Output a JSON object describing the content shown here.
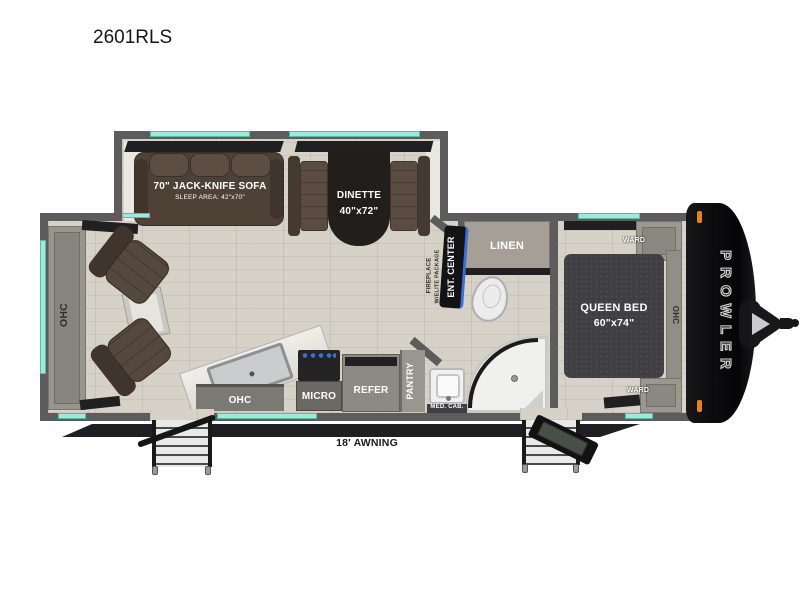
{
  "title": "2601RLS",
  "colors": {
    "teal": "#9fe9da",
    "wall": "#5c5c5c",
    "cap": "#0d0d0f",
    "marker": "#e8821c",
    "sofa_brown": "#4e4237",
    "bed_gray": "#3f3f43",
    "floor_base": "#d7d2c8",
    "accent_blue": "#3a6fd8"
  },
  "living": {
    "ohc_rear": "OHC",
    "sofa_label": "70\" JACK-KNIFE SOFA",
    "sofa_sublabel": "SLEEP AREA: 42\"x70\"",
    "dinette_label": "DINETTE",
    "dinette_size": "40\"x72\"",
    "ent_center": "ENT. CENTER",
    "fireplace_line1": "FIREPLACE",
    "fireplace_line2": "W/ELITE PACKAGE"
  },
  "kitchen": {
    "ohc": "OHC",
    "micro": "MICRO",
    "refer": "REFER",
    "pantry": "PANTRY"
  },
  "bathroom": {
    "linen": "LINEN",
    "med_cab": "MED. CAB."
  },
  "bedroom": {
    "queen_label": "QUEEN BED",
    "queen_size": "60\"x74\"",
    "ward_top": "WARD",
    "ward_bottom": "WARD",
    "ohc": "OHC"
  },
  "exterior": {
    "awning_label": "18' AWNING",
    "brand": "PROWLER"
  }
}
